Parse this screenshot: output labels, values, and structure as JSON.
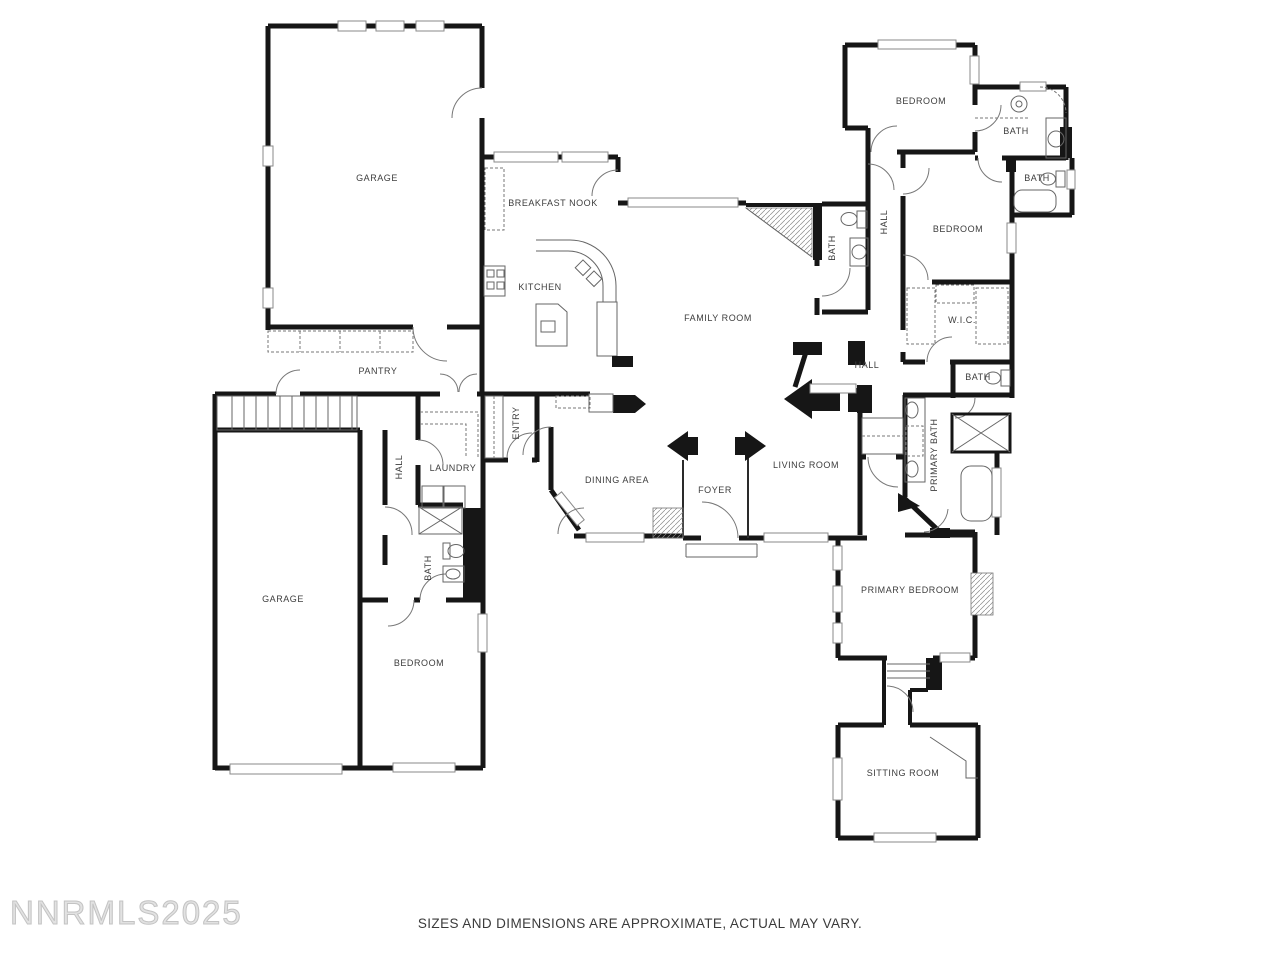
{
  "plan": {
    "watermark": "NNRMLS2025",
    "disclaimer": "SIZES AND DIMENSIONS ARE APPROXIMATE, ACTUAL MAY VARY.",
    "wall_color": "#161616",
    "fixture_line_color": "#666666",
    "label_color": "#3d3d3d",
    "rooms": {
      "garage1": {
        "label": "GARAGE"
      },
      "breakfastNook": {
        "label": "BREAKFAST NOOK"
      },
      "kitchen": {
        "label": "KITCHEN"
      },
      "familyRoom": {
        "label": "FAMILY ROOM"
      },
      "pantry": {
        "label": "PANTRY"
      },
      "bedroom3": {
        "label": "BEDROOM"
      },
      "bath1": {
        "label": "BATH"
      },
      "bath2": {
        "label": "BATH"
      },
      "hallWing": {
        "label": "HALL"
      },
      "bath4": {
        "label": "BATH"
      },
      "bedroom2": {
        "label": "BEDROOM"
      },
      "wic": {
        "label": "W.I.C."
      },
      "hallMid": {
        "label": "HALL"
      },
      "bath3": {
        "label": "BATH"
      },
      "entry": {
        "label": "ENTRY"
      },
      "laundry": {
        "label": "LAUNDRY"
      },
      "hallLeft": {
        "label": "HALL"
      },
      "dining": {
        "label": "DINING AREA"
      },
      "foyer": {
        "label": "FOYER"
      },
      "living": {
        "label": "LIVING ROOM"
      },
      "primaryBath": {
        "label": "PRIMARY BATH"
      },
      "bathLeft": {
        "label": "BATH"
      },
      "garage2": {
        "label": "GARAGE"
      },
      "bedroomLeft": {
        "label": "BEDROOM"
      },
      "primaryBedroom": {
        "label": "PRIMARY BEDROOM"
      },
      "sittingRoom": {
        "label": "SITTING ROOM"
      }
    }
  }
}
